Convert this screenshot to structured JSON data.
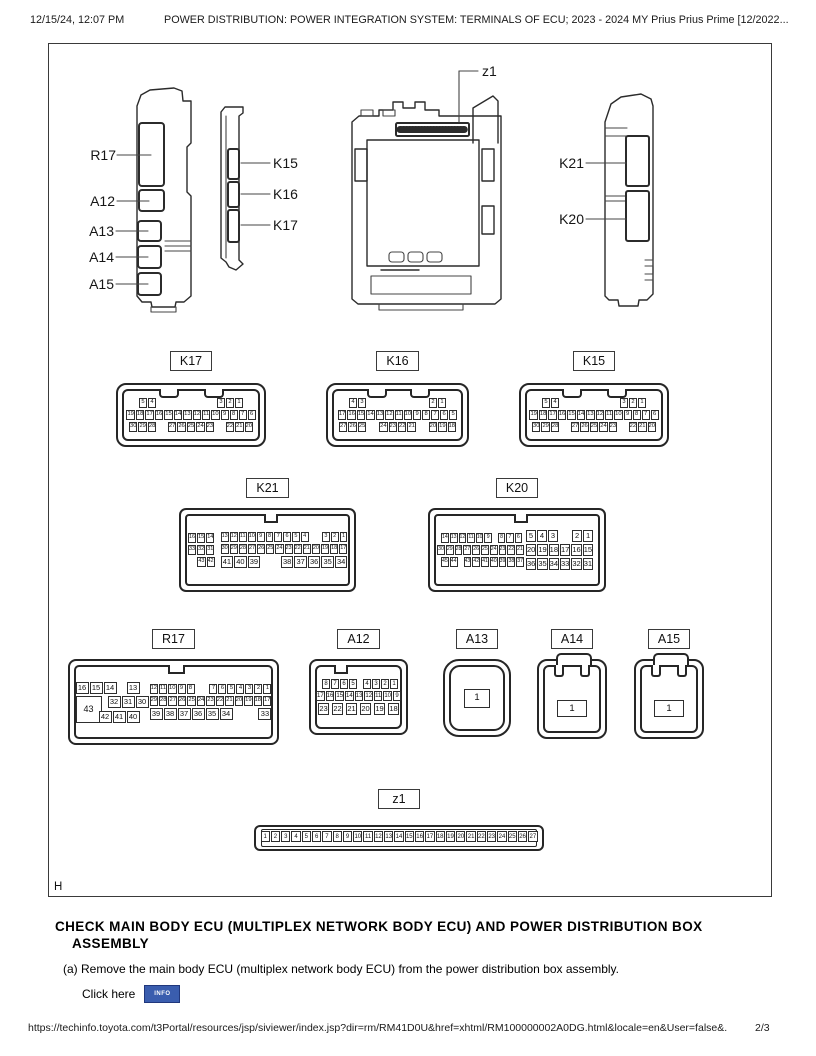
{
  "header": {
    "datetime": "12/15/24, 12:07 PM",
    "title": "POWER DISTRIBUTION: POWER INTEGRATION SYSTEM: TERMINALS OF ECU; 2023 - 2024 MY Prius Prius Prime [12/2022..."
  },
  "figure": {
    "corner_label": "H",
    "callouts": {
      "r17": "R17",
      "a12": "A12",
      "a13": "A13",
      "a14": "A14",
      "a15": "A15",
      "k15": "K15",
      "k16": "K16",
      "k17": "K17",
      "k21": "K21",
      "k20": "K20",
      "z1": "z1"
    },
    "connectors": [
      {
        "id": "K17",
        "label": "K17",
        "rows": [
          {
            "cls": "split pad1",
            "g": [
              [
                "5",
                "4"
              ],
              [
                "3",
                "2",
                "1"
              ]
            ]
          },
          {
            "g": [
              [
                "19",
                "18",
                "17",
                "16",
                "15",
                "14",
                "13",
                "12",
                "11",
                "10",
                "9",
                "8",
                "7",
                "6"
              ]
            ]
          },
          {
            "cls": "split",
            "g": [
              [
                "30",
                "29",
                "28"
              ],
              [
                "27",
                "26",
                "25",
                "24",
                "23"
              ],
              [
                "22",
                "21",
                "20"
              ]
            ]
          }
        ]
      },
      {
        "id": "K16",
        "label": "K16",
        "rows": [
          {
            "cls": "split pad1",
            "g": [
              [
                "4",
                "3"
              ],
              [
                "2",
                "1"
              ]
            ]
          },
          {
            "g": [
              [
                "17",
                "16",
                "15",
                "14",
                "13",
                "12",
                "11",
                "10",
                "9",
                "8",
                "7",
                "6",
                "5"
              ]
            ]
          },
          {
            "cls": "split",
            "g": [
              [
                "27",
                "26",
                "25"
              ],
              [
                "24",
                "23",
                "22",
                "21"
              ],
              [
                "20",
                "19",
                "18"
              ]
            ]
          }
        ]
      },
      {
        "id": "K15",
        "label": "K15",
        "rows": [
          {
            "cls": "split pad1",
            "g": [
              [
                "5",
                "4"
              ],
              [
                "3",
                "2",
                "1"
              ]
            ]
          },
          {
            "g": [
              [
                "19",
                "18",
                "17",
                "16",
                "15",
                "14",
                "13",
                "12",
                "11",
                "10",
                "9",
                "8",
                "7",
                "6"
              ]
            ]
          },
          {
            "cls": "split",
            "g": [
              [
                "30",
                "29",
                "28"
              ],
              [
                "27",
                "26",
                "25",
                "24",
                "23"
              ],
              [
                "22",
                "21",
                "20"
              ]
            ]
          }
        ]
      },
      {
        "id": "K21",
        "label": "K21",
        "blocks": [
          {
            "cls": "side",
            "rows": [
              {
                "g": [
                  [
                    "16",
                    "15",
                    "14"
                  ]
                ]
              },
              {
                "g": [
                  [
                    "33",
                    "32",
                    "31"
                  ]
                ]
              },
              {
                "cls": "right",
                "g": [
                  [
                    "43",
                    "42"
                  ]
                ]
              }
            ]
          },
          {
            "cls": "main",
            "rows": [
              {
                "cls": "split",
                "g": [
                  [
                    "13",
                    "12",
                    "11",
                    "10",
                    "9",
                    "8",
                    "7",
                    "6",
                    "5",
                    "4"
                  ],
                  [
                    "3",
                    "2",
                    "1"
                  ]
                ]
              },
              {
                "g": [
                  [
                    "30",
                    "29",
                    "28",
                    "27",
                    "26",
                    "25",
                    "24",
                    "23",
                    "22",
                    "21",
                    "20",
                    "19",
                    "18",
                    "17"
                  ]
                ]
              },
              {
                "cls": "split lg",
                "g": [
                  [
                    "41",
                    "40",
                    "39"
                  ],
                  [
                    "38",
                    "37",
                    "36",
                    "35",
                    "34"
                  ]
                ]
              }
            ]
          }
        ]
      },
      {
        "id": "K20",
        "label": "K20",
        "blocks": [
          {
            "cls": "k20l",
            "rows": [
              {
                "cls": "split",
                "g": [
                  [
                    "14",
                    "13",
                    "12",
                    "11",
                    "10",
                    "9"
                  ],
                  [
                    "8",
                    "7",
                    "6"
                  ]
                ]
              },
              {
                "g": [
                  [
                    "30",
                    "29",
                    "28",
                    "27",
                    "26",
                    "25",
                    "24",
                    "23",
                    "22",
                    "21"
                  ]
                ]
              },
              {
                "cls": "split",
                "g": [
                  [
                    "45",
                    "44"
                  ],
                  [
                    "43",
                    "42",
                    "41",
                    "40",
                    "39",
                    "38",
                    "37"
                  ]
                ]
              }
            ]
          },
          {
            "cls": "k20r",
            "rows": [
              {
                "cls": "split",
                "g": [
                  [
                    "5",
                    "4",
                    "3"
                  ],
                  [
                    "2",
                    "1"
                  ]
                ]
              },
              {
                "g": [
                  [
                    "20",
                    "19",
                    "18",
                    "17",
                    "16",
                    "15"
                  ]
                ]
              },
              {
                "g": [
                  [
                    "36",
                    "35",
                    "34",
                    "33",
                    "32",
                    "31"
                  ]
                ]
              }
            ]
          }
        ]
      },
      {
        "id": "R17",
        "label": "R17",
        "blocks": [
          {
            "cls": "r17l",
            "rows": [
              {
                "cls": "split",
                "g": [
                  [
                    "16",
                    "15",
                    "14"
                  ],
                  [
                    "13"
                  ]
                ]
              },
              {
                "cls": "r17mid",
                "g": [
                  [
                    "43"
                  ],
                  [
                    "32",
                    "31",
                    "30"
                  ]
                ]
              },
              {
                "cls": "right r17bot",
                "g": [
                  [
                    "42",
                    "41",
                    "40"
                  ]
                ]
              }
            ]
          },
          {
            "cls": "r17r",
            "rows": [
              {
                "cls": "split",
                "g": [
                  [
                    "12",
                    "11",
                    "10",
                    "9",
                    "8"
                  ],
                  [
                    "7",
                    "6",
                    "5",
                    "4",
                    "3",
                    "2",
                    "1"
                  ]
                ]
              },
              {
                "g": [
                  [
                    "29",
                    "28",
                    "27",
                    "26",
                    "25",
                    "24",
                    "23",
                    "22",
                    "21",
                    "20",
                    "19",
                    "18",
                    "17"
                  ]
                ]
              },
              {
                "cls": "split md",
                "g": [
                  [
                    "39",
                    "38",
                    "37",
                    "36",
                    "35",
                    "34"
                  ],
                  [
                    "33"
                  ]
                ]
              }
            ]
          }
        ]
      },
      {
        "id": "A12",
        "label": "A12",
        "rows": [
          {
            "cls": "split",
            "g": [
              [
                "8",
                "7",
                "6",
                "5"
              ],
              [
                "4",
                "3",
                "2",
                "1"
              ]
            ]
          },
          {
            "g": [
              [
                "17",
                "16",
                "15",
                "14",
                "13",
                "12",
                "11",
                "10",
                "9"
              ]
            ]
          },
          {
            "cls": "a12b",
            "g": [
              [
                "23",
                "22",
                "21",
                "20",
                "19",
                "18"
              ]
            ]
          }
        ]
      },
      {
        "id": "A13",
        "label": "A13",
        "single": "1"
      },
      {
        "id": "A14",
        "label": "A14",
        "single": "1"
      },
      {
        "id": "A15",
        "label": "A15",
        "single": "1"
      },
      {
        "id": "z1",
        "label": "z1",
        "rows": [
          {
            "g": [
              [
                "1",
                "2",
                "3",
                "4",
                "5",
                "6",
                "7",
                "8",
                "9",
                "10",
                "11",
                "12",
                "13",
                "14",
                "15",
                "16",
                "17",
                "18",
                "19",
                "20",
                "21",
                "22",
                "23",
                "24",
                "25",
                "26",
                "27"
              ]
            ]
          }
        ]
      }
    ]
  },
  "section": {
    "heading_line1": "CHECK MAIN BODY ECU (MULTIPLEX NETWORK BODY ECU) AND POWER DISTRIBUTION BOX",
    "heading_line2": "ASSEMBLY",
    "step": "(a) Remove the main body ECU (multiplex network body ECU) from the power distribution box assembly.",
    "link_label": "Click here",
    "info_button": "INFO"
  },
  "footer": {
    "url": "https://techinfo.toyota.com/t3Portal/resources/jsp/siviewer/index.jsp?dir=rm/RM41D0U&href=xhtml/RM100000002A0DG.html&locale=en&User=false&...",
    "page": "2/3"
  },
  "colors": {
    "info_button_bg": "#3a5dae",
    "info_button_border": "#20377c",
    "line_art": "#2b2b2b"
  }
}
